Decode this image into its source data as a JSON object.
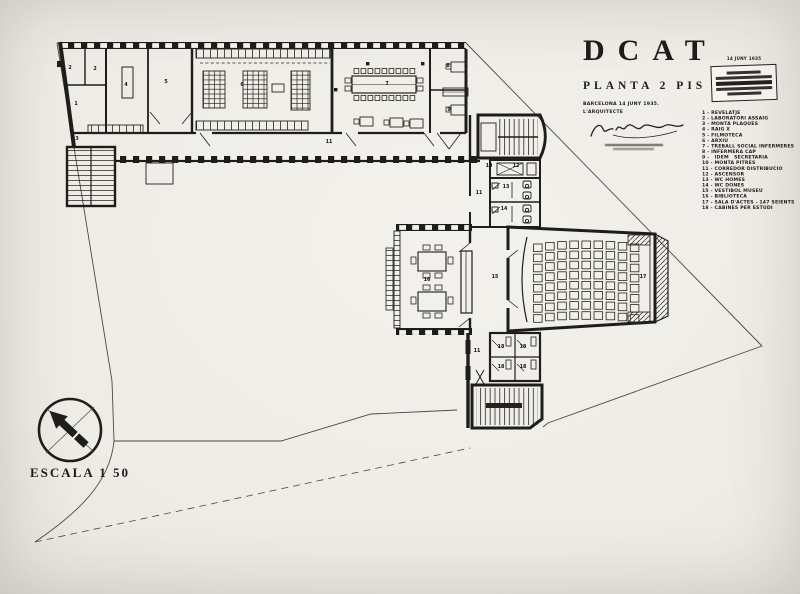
{
  "photo": {
    "paper": "#f3f1ec",
    "ink": "#1d1d1b",
    "edge": "#cfccc5"
  },
  "title_block": {
    "title": "DCAT",
    "subtitle": "PLANTA 2 PIS",
    "date_line": "BARCELONA 14 JUNY 1935.",
    "architect_label": "L'ARQUITECTE",
    "stamp_date": "14 JUNY 1935"
  },
  "legend": {
    "items": [
      "1 - REVELATJE",
      "2 - LABORATORI ASSAIG",
      "3 - MONTA PLAQUES",
      "4 - RAIG X",
      "5 - FILMOTECA",
      "6 - ARXIU",
      "7 - TREBALL SOCIAL INFERMERES",
      "8 - INFERMERA CAP",
      "9 -   IDEM   SECRETARIA",
      "10 - MONTA PITRES",
      "11 - CORREDOR DISTRIBUCIO",
      "12 - ASCENSOR",
      "13 - WC HOMES",
      "14 - WC DONES",
      "15 - VESTIBOL MUSEU",
      "16 - BIBLIOTECA",
      "17 - SALA D'ACTES - 147 SEIENTS",
      "18 - CABINES PER ESTUDI"
    ]
  },
  "scale": {
    "label": "ESCALA 1 50"
  },
  "plan": {
    "labels": [
      {
        "n": "2",
        "x": 70,
        "y": 68
      },
      {
        "n": "2",
        "x": 95,
        "y": 69
      },
      {
        "n": "1",
        "x": 76,
        "y": 104
      },
      {
        "n": "3",
        "x": 77,
        "y": 139
      },
      {
        "n": "4",
        "x": 126,
        "y": 85
      },
      {
        "n": "5",
        "x": 166,
        "y": 82
      },
      {
        "n": "6",
        "x": 242,
        "y": 85
      },
      {
        "n": "7",
        "x": 387,
        "y": 84
      },
      {
        "n": "8",
        "x": 448,
        "y": 66
      },
      {
        "n": "9",
        "x": 449,
        "y": 110
      },
      {
        "n": "11",
        "x": 329,
        "y": 142
      },
      {
        "n": "10",
        "x": 489,
        "y": 166
      },
      {
        "n": "12",
        "x": 516,
        "y": 166
      },
      {
        "n": "13",
        "x": 506,
        "y": 187
      },
      {
        "n": "14",
        "x": 504,
        "y": 209
      },
      {
        "n": "11",
        "x": 479,
        "y": 193
      },
      {
        "n": "16",
        "x": 427,
        "y": 280
      },
      {
        "n": "15",
        "x": 495,
        "y": 277
      },
      {
        "n": "17",
        "x": 643,
        "y": 277
      },
      {
        "n": "11",
        "x": 477,
        "y": 351
      },
      {
        "n": "18",
        "x": 501,
        "y": 347
      },
      {
        "n": "18",
        "x": 523,
        "y": 347
      },
      {
        "n": "18",
        "x": 501,
        "y": 367
      },
      {
        "n": "18",
        "x": 523,
        "y": 367
      }
    ]
  }
}
